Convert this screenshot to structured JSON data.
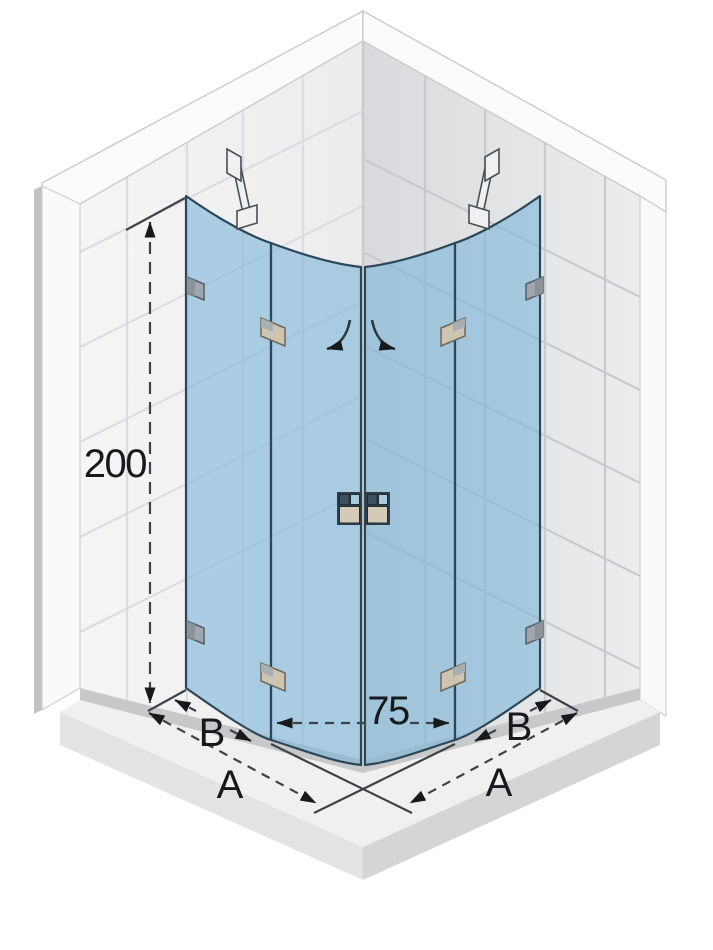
{
  "meta": {
    "type": "technical-drawing",
    "subject": "quadrant corner shower enclosure, isometric view with dimensions"
  },
  "dimensions": {
    "height": "200",
    "front_width": "75",
    "side_left_total": "A",
    "side_right_total": "A",
    "panel_left": "B",
    "panel_right": "B"
  },
  "colors": {
    "glass": "#77b3d8",
    "glass_outline": "#2c4858",
    "tile_left_wall": "#f3f3f5",
    "tile_right_wall_dark": "#d8dadd",
    "tile_right_wall_light": "#eceded",
    "grout_left": "#dcdde0",
    "grout_right": "#c8cacd",
    "floor": "#f0f0f1",
    "floor_edge_left": "#e3e3e4",
    "floor_edge_right": "#d4d5d7",
    "junction_band": "#c6c8ca",
    "hardware_gray": "#9fa7ad",
    "hinge_tan": "#cdc4b2",
    "handle_beige": "#d3cab7",
    "handle_navy": "#3d5260",
    "handle_blue": "#a9cadc",
    "support_bar": "#eef0f1",
    "dimension_line": "#3f4348",
    "dimension_text": "#17191c"
  },
  "icons": [
    "wall-support-bar-icon",
    "glass-clamp-icon",
    "wall-bracket-icon",
    "hinge-icon",
    "door-knob-icon",
    "swing-arrow-icon",
    "dimension-arrow-icon"
  ]
}
